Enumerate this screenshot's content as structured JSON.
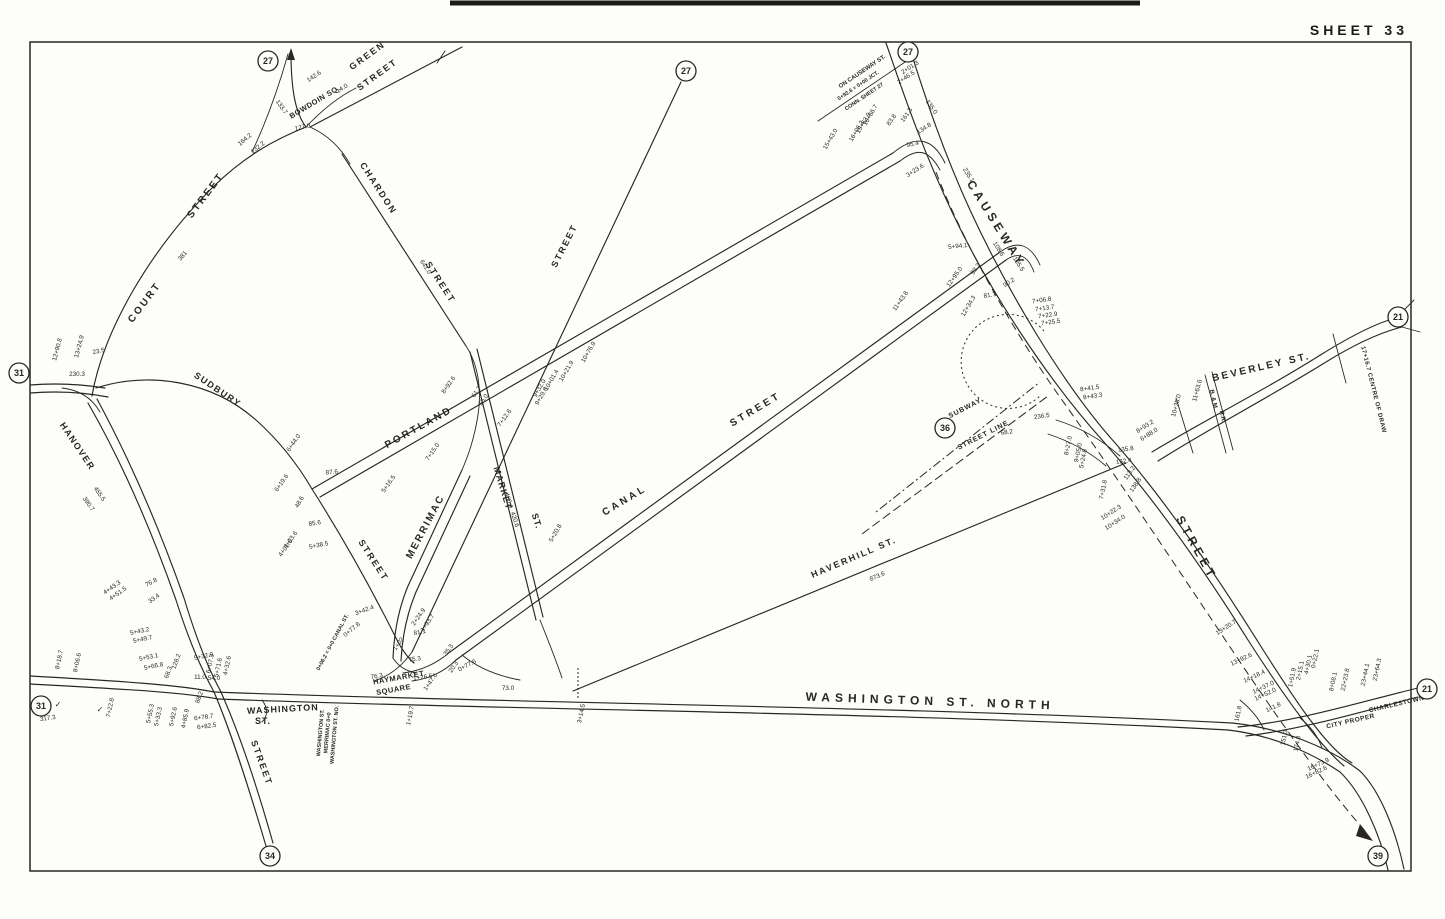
{
  "sheet": {
    "title": "SHEET 33"
  },
  "map": {
    "ink_color": "#2a2722",
    "paper_color": "#fdfdfb",
    "street_labels": [
      {
        "t": "GREEN",
        "x": 369,
        "y": 58,
        "r": -36,
        "s": 9,
        "ls": 2
      },
      {
        "t": "STREET",
        "x": 379,
        "y": 77,
        "r": -36,
        "s": 9,
        "ls": 2
      },
      {
        "t": "BOWDOIN SQ.",
        "x": 316,
        "y": 104,
        "r": -31,
        "s": 7.5,
        "ls": 0.5
      },
      {
        "t": "CHARDON",
        "x": 376,
        "y": 190,
        "r": 57,
        "s": 9,
        "ls": 2
      },
      {
        "t": "STREET",
        "x": 438,
        "y": 284,
        "r": 57,
        "s": 9,
        "ls": 2
      },
      {
        "t": "COURT",
        "x": 147,
        "y": 304,
        "r": -53,
        "s": 10,
        "ls": 2.5
      },
      {
        "t": "STREET",
        "x": 208,
        "y": 197,
        "r": -53,
        "s": 10,
        "ls": 2.5
      },
      {
        "t": "STREET",
        "x": 567,
        "y": 247,
        "r": -63,
        "s": 9,
        "ls": 2
      },
      {
        "t": "SUDBURY",
        "x": 216,
        "y": 392,
        "r": 34,
        "s": 9,
        "ls": 1.5
      },
      {
        "t": "HANOVER",
        "x": 75,
        "y": 448,
        "r": 56,
        "s": 9,
        "ls": 1.5
      },
      {
        "t": "PORTLAND",
        "x": 420,
        "y": 430,
        "r": -29,
        "s": 10,
        "ls": 2.5
      },
      {
        "t": "MERRIMAC",
        "x": 428,
        "y": 528,
        "r": -62,
        "s": 10,
        "ls": 2
      },
      {
        "t": "STREET",
        "x": 371,
        "y": 562,
        "r": 57,
        "s": 9,
        "ls": 2
      },
      {
        "t": "MARKET",
        "x": 500,
        "y": 489,
        "r": 73,
        "s": 9,
        "ls": 1
      },
      {
        "t": "ST.",
        "x": 534,
        "y": 522,
        "r": 73,
        "s": 9,
        "ls": 1
      },
      {
        "t": "CANAL",
        "x": 626,
        "y": 503,
        "r": -31,
        "s": 10,
        "ls": 3
      },
      {
        "t": "STREET",
        "x": 757,
        "y": 412,
        "r": -31,
        "s": 10,
        "ls": 3
      },
      {
        "t": "HAVERHILL ST.",
        "x": 855,
        "y": 560,
        "r": -23,
        "s": 9,
        "ls": 2
      },
      {
        "t": "CAUSEWAY",
        "x": 993,
        "y": 226,
        "r": 58,
        "s": 12,
        "ls": 4
      },
      {
        "t": "STREET",
        "x": 1193,
        "y": 550,
        "r": 61,
        "s": 12,
        "ls": 4
      },
      {
        "t": "BEVERLEY ST.",
        "x": 1262,
        "y": 370,
        "r": -13,
        "s": 10,
        "ls": 2.5
      },
      {
        "t": "WASHINGTON ST. NORTH",
        "x": 930,
        "y": 705,
        "r": 2,
        "s": 12,
        "ls": 5
      },
      {
        "t": "WASHINGTON",
        "x": 283,
        "y": 712,
        "r": -3,
        "s": 9,
        "ls": 1
      },
      {
        "t": "ST.",
        "x": 263,
        "y": 724,
        "r": 0,
        "s": 9,
        "ls": 1
      },
      {
        "t": "HAYMARKET",
        "x": 399,
        "y": 680,
        "r": -10,
        "s": 7.5,
        "ls": 0.5
      },
      {
        "t": "SQUARE",
        "x": 394,
        "y": 692,
        "r": -10,
        "s": 7.5,
        "ls": 0.5
      },
      {
        "t": "STREET",
        "x": 259,
        "y": 764,
        "r": 70,
        "s": 9,
        "ls": 2
      },
      {
        "t": "CITY PROPER",
        "x": 1351,
        "y": 723,
        "r": -13,
        "s": 6.5,
        "ls": 0.5
      },
      {
        "t": "CHARLESTOWN",
        "x": 1397,
        "y": 706,
        "r": -13,
        "s": 6.5,
        "ls": 0.5
      },
      {
        "t": "SUBWAY",
        "x": 966,
        "y": 410,
        "r": -27,
        "s": 7,
        "ls": 1
      },
      {
        "t": "STREET LINE",
        "x": 984,
        "y": 437,
        "r": -27,
        "s": 7,
        "ls": 1
      },
      {
        "t": "ON CAUSEWAY ST.",
        "x": 863,
        "y": 73,
        "r": -34,
        "s": 6,
        "ls": 0
      },
      {
        "t": "0+92.6 = 0+00 JCT.",
        "x": 859,
        "y": 87,
        "r": -34,
        "s": 5.5,
        "ls": 0
      },
      {
        "t": "CONN. SHEET 27",
        "x": 865,
        "y": 98,
        "r": -34,
        "s": 5.5,
        "ls": 0
      },
      {
        "t": "B. & M.",
        "x": 1212,
        "y": 400,
        "r": 78,
        "s": 6,
        "ls": 0
      },
      {
        "t": "R.R.",
        "x": 1221,
        "y": 417,
        "r": 78,
        "s": 6,
        "ls": 0
      },
      {
        "t": "17+16.7  CENTRE OF DRAW",
        "x": 1372,
        "y": 390,
        "r": 76,
        "s": 6,
        "ls": 0.5
      },
      {
        "t": "WASHINGTON ST.",
        "x": 322,
        "y": 733,
        "r": -85,
        "s": 5.5,
        "ls": 0
      },
      {
        "t": "MERRIMAC 0+0",
        "x": 329,
        "y": 733,
        "r": -85,
        "s": 5.5,
        "ls": 0
      },
      {
        "t": "WASHINGTON ST. NO.",
        "x": 336,
        "y": 735,
        "r": -85,
        "s": 5.5,
        "ls": 0
      },
      {
        "t": "0+06.2 = 0+0 CANAL ST.",
        "x": 334,
        "y": 643,
        "r": -62,
        "s": 5.5,
        "ls": 0
      }
    ],
    "annotations": [
      {
        "t": "142.6",
        "x": 315,
        "y": 78,
        "r": -33
      },
      {
        "t": "14.0",
        "x": 343,
        "y": 90,
        "r": -33
      },
      {
        "t": "133.7",
        "x": 280,
        "y": 108,
        "r": 55
      },
      {
        "t": "127.0",
        "x": 303,
        "y": 129,
        "r": -12
      },
      {
        "t": "164.2",
        "x": 246,
        "y": 141,
        "r": -40
      },
      {
        "t": "232.2",
        "x": 259,
        "y": 149,
        "r": -40
      },
      {
        "t": "381",
        "x": 184,
        "y": 257,
        "r": -50
      },
      {
        "t": "641.0",
        "x": 424,
        "y": 268,
        "r": 57
      },
      {
        "t": "12+90.8",
        "x": 59,
        "y": 350,
        "r": -75
      },
      {
        "t": "13+24.9",
        "x": 81,
        "y": 347,
        "r": -75
      },
      {
        "t": "23.5",
        "x": 99,
        "y": 353,
        "r": -12
      },
      {
        "t": "230.3",
        "x": 77,
        "y": 376,
        "r": 0
      },
      {
        "t": "455.5",
        "x": 98,
        "y": 495,
        "r": 55
      },
      {
        "t": "390.7",
        "x": 87,
        "y": 505,
        "r": 55
      },
      {
        "t": "8+18.7",
        "x": 61,
        "y": 660,
        "r": -78
      },
      {
        "t": "8+06.6",
        "x": 79,
        "y": 663,
        "r": -78
      },
      {
        "t": "317.3",
        "x": 48,
        "y": 720,
        "r": -8
      },
      {
        "t": "7+22.8",
        "x": 112,
        "y": 708,
        "r": -78
      },
      {
        "t": "✓",
        "x": 58,
        "y": 707,
        "r": 0,
        "s": 8
      },
      {
        "t": "✓",
        "x": 100,
        "y": 712,
        "r": 0,
        "s": 8
      },
      {
        "t": "4+43.3",
        "x": 113,
        "y": 589,
        "r": -35
      },
      {
        "t": "4+51.5",
        "x": 119,
        "y": 595,
        "r": -35
      },
      {
        "t": "76.8",
        "x": 152,
        "y": 584,
        "r": -28
      },
      {
        "t": "33.4",
        "x": 155,
        "y": 600,
        "r": -35
      },
      {
        "t": "5+43.2",
        "x": 140,
        "y": 633,
        "r": -12
      },
      {
        "t": "5+49.7",
        "x": 143,
        "y": 641,
        "r": -12
      },
      {
        "t": "5+53.1",
        "x": 149,
        "y": 659,
        "r": -12
      },
      {
        "t": "5+66.8",
        "x": 154,
        "y": 668,
        "r": -12
      },
      {
        "t": "128.2",
        "x": 178,
        "y": 662,
        "r": -70
      },
      {
        "t": "68.3",
        "x": 170,
        "y": 673,
        "r": -70
      },
      {
        "t": "5+32.9",
        "x": 204,
        "y": 658,
        "r": -12
      },
      {
        "t": "6+07.3",
        "x": 212,
        "y": 664,
        "r": -78
      },
      {
        "t": "5+71.6",
        "x": 220,
        "y": 668,
        "r": -78
      },
      {
        "t": "4+32.6",
        "x": 229,
        "y": 666,
        "r": -78
      },
      {
        "t": "11.0",
        "x": 200,
        "y": 679,
        "r": 0
      },
      {
        "t": "54.0",
        "x": 214,
        "y": 680,
        "r": 0
      },
      {
        "t": "88.2",
        "x": 201,
        "y": 698,
        "r": -70
      },
      {
        "t": "5+55.3",
        "x": 152,
        "y": 714,
        "r": -78
      },
      {
        "t": "5+33.3",
        "x": 160,
        "y": 717,
        "r": -78
      },
      {
        "t": "5+92.6",
        "x": 175,
        "y": 717,
        "r": -78
      },
      {
        "t": "4+85.9",
        "x": 187,
        "y": 719,
        "r": -78
      },
      {
        "t": "6+78.7",
        "x": 204,
        "y": 719,
        "r": -8
      },
      {
        "t": "6+82.5",
        "x": 207,
        "y": 728,
        "r": -8
      },
      {
        "t": "76.3",
        "x": 377,
        "y": 678,
        "r": -10
      },
      {
        "t": "3+42.4",
        "x": 365,
        "y": 612,
        "r": -20
      },
      {
        "t": "0+77.8",
        "x": 353,
        "y": 631,
        "r": -40
      },
      {
        "t": "2+24.9",
        "x": 420,
        "y": 618,
        "r": -55
      },
      {
        "t": "1+93.7",
        "x": 429,
        "y": 624,
        "r": -55
      },
      {
        "t": "81.1",
        "x": 420,
        "y": 634,
        "r": -10
      },
      {
        "t": "1+02",
        "x": 400,
        "y": 645,
        "r": -55
      },
      {
        "t": "75.3",
        "x": 415,
        "y": 661,
        "r": -8
      },
      {
        "t": "1+26.5",
        "x": 423,
        "y": 679,
        "r": -8
      },
      {
        "t": "1+47.6",
        "x": 432,
        "y": 683,
        "r": -55
      },
      {
        "t": "35.3",
        "x": 450,
        "y": 651,
        "r": -55
      },
      {
        "t": "20.3",
        "x": 455,
        "y": 668,
        "r": -55
      },
      {
        "t": "0+77.6",
        "x": 468,
        "y": 667,
        "r": -28
      },
      {
        "t": "73.0",
        "x": 508,
        "y": 690,
        "r": 0
      },
      {
        "t": "1+19.7",
        "x": 412,
        "y": 716,
        "r": -78
      },
      {
        "t": "3+14.5",
        "x": 583,
        "y": 714,
        "r": -78
      },
      {
        "t": "6+44.0",
        "x": 295,
        "y": 444,
        "r": -55
      },
      {
        "t": "6+19.6",
        "x": 283,
        "y": 484,
        "r": -55
      },
      {
        "t": "48.6",
        "x": 301,
        "y": 503,
        "r": -60
      },
      {
        "t": "87.6",
        "x": 332,
        "y": 474,
        "r": -6
      },
      {
        "t": "5+16.5",
        "x": 390,
        "y": 485,
        "r": -55
      },
      {
        "t": "7+15.0",
        "x": 434,
        "y": 453,
        "r": -55
      },
      {
        "t": "8+92.6",
        "x": 450,
        "y": 386,
        "r": -55
      },
      {
        "t": "85.6",
        "x": 315,
        "y": 525,
        "r": -8
      },
      {
        "t": "4+03.6",
        "x": 292,
        "y": 541,
        "r": -55
      },
      {
        "t": "4+01.6",
        "x": 287,
        "y": 549,
        "r": -55
      },
      {
        "t": "5+38.5",
        "x": 319,
        "y": 547,
        "r": -12
      },
      {
        "t": "61.7",
        "x": 478,
        "y": 393,
        "r": -55
      },
      {
        "t": "55.0",
        "x": 485,
        "y": 401,
        "r": -55
      },
      {
        "t": "7+12.8",
        "x": 506,
        "y": 419,
        "r": -55
      },
      {
        "t": "460.4",
        "x": 507,
        "y": 501,
        "r": 72
      },
      {
        "t": "420.6",
        "x": 513,
        "y": 520,
        "r": 72
      },
      {
        "t": "5+20.8",
        "x": 557,
        "y": 534,
        "r": -60
      },
      {
        "t": "10+76.9",
        "x": 590,
        "y": 353,
        "r": -60
      },
      {
        "t": "10+21.9",
        "x": 568,
        "y": 372,
        "r": -60
      },
      {
        "t": "10+01.4",
        "x": 553,
        "y": 381,
        "r": -60
      },
      {
        "t": "9+32.0",
        "x": 541,
        "y": 389,
        "r": -60
      },
      {
        "t": "9+29.6",
        "x": 543,
        "y": 397,
        "r": -60
      },
      {
        "t": "2+01.3",
        "x": 911,
        "y": 69,
        "r": -33
      },
      {
        "t": "2+46.5",
        "x": 907,
        "y": 79,
        "r": -33
      },
      {
        "t": "135.0",
        "x": 930,
        "y": 108,
        "r": 55
      },
      {
        "t": "134.8",
        "x": 925,
        "y": 130,
        "r": -33
      },
      {
        "t": "16+66.7",
        "x": 872,
        "y": 116,
        "r": -60
      },
      {
        "t": "15+63.9",
        "x": 865,
        "y": 124,
        "r": -60
      },
      {
        "t": "16+06.2",
        "x": 858,
        "y": 132,
        "r": -60
      },
      {
        "t": "15+43.0",
        "x": 832,
        "y": 140,
        "r": -60
      },
      {
        "t": "83.8",
        "x": 893,
        "y": 121,
        "r": -55
      },
      {
        "t": "161.3",
        "x": 908,
        "y": 116,
        "r": -55
      },
      {
        "t": "95.4",
        "x": 913,
        "y": 146,
        "r": -12
      },
      {
        "t": "3+23.6",
        "x": 916,
        "y": 172,
        "r": -33
      },
      {
        "t": "235.1",
        "x": 967,
        "y": 176,
        "r": 57
      },
      {
        "t": "5+94.1",
        "x": 958,
        "y": 248,
        "r": -6
      },
      {
        "t": "108.6",
        "x": 997,
        "y": 250,
        "r": 57
      },
      {
        "t": "105.5",
        "x": 1017,
        "y": 265,
        "r": 57
      },
      {
        "t": "92.2",
        "x": 977,
        "y": 270,
        "r": -55
      },
      {
        "t": "12+95.0",
        "x": 956,
        "y": 278,
        "r": -55
      },
      {
        "t": "90.2",
        "x": 1010,
        "y": 284,
        "r": -33
      },
      {
        "t": "81.7",
        "x": 990,
        "y": 297,
        "r": -8
      },
      {
        "t": "12+34.3",
        "x": 970,
        "y": 307,
        "r": -60
      },
      {
        "t": "11+43.8",
        "x": 902,
        "y": 302,
        "r": -55
      },
      {
        "t": "7+06.8",
        "x": 1042,
        "y": 302,
        "r": -8
      },
      {
        "t": "7+13.7",
        "x": 1045,
        "y": 310,
        "r": -8
      },
      {
        "t": "7+22.9",
        "x": 1048,
        "y": 317,
        "r": -8
      },
      {
        "t": "7+25.5",
        "x": 1051,
        "y": 324,
        "r": -8
      },
      {
        "t": "8+41.5",
        "x": 1090,
        "y": 390,
        "r": -8
      },
      {
        "t": "8+43.3",
        "x": 1093,
        "y": 398,
        "r": -8
      },
      {
        "t": "236.5",
        "x": 1042,
        "y": 418,
        "r": -8
      },
      {
        "t": "68.2",
        "x": 1007,
        "y": 434,
        "r": -8
      },
      {
        "t": "8+93.2",
        "x": 1146,
        "y": 428,
        "r": -33
      },
      {
        "t": "6+88.0",
        "x": 1150,
        "y": 436,
        "r": -33
      },
      {
        "t": "135.8",
        "x": 1126,
        "y": 451,
        "r": -8
      },
      {
        "t": "132.4",
        "x": 1124,
        "y": 463,
        "r": -8
      },
      {
        "t": "113.2",
        "x": 1131,
        "y": 474,
        "r": -55
      },
      {
        "t": "138.8",
        "x": 1137,
        "y": 486,
        "r": -55
      },
      {
        "t": "8+27.0",
        "x": 1070,
        "y": 446,
        "r": -78
      },
      {
        "t": "9+05.0",
        "x": 1080,
        "y": 453,
        "r": -78
      },
      {
        "t": "5+24.8",
        "x": 1085,
        "y": 459,
        "r": -78
      },
      {
        "t": "7+31.8",
        "x": 1105,
        "y": 490,
        "r": -78
      },
      {
        "t": "10+22.3",
        "x": 1112,
        "y": 514,
        "r": -33
      },
      {
        "t": "10+34.0",
        "x": 1116,
        "y": 524,
        "r": -33
      },
      {
        "t": "10+35.0",
        "x": 1178,
        "y": 406,
        "r": -75
      },
      {
        "t": "11+63.6",
        "x": 1199,
        "y": 391,
        "r": -75
      },
      {
        "t": "873.6",
        "x": 878,
        "y": 578,
        "r": -23
      },
      {
        "t": "13+20.7",
        "x": 1227,
        "y": 629,
        "r": -33
      },
      {
        "t": "13+92.6",
        "x": 1242,
        "y": 661,
        "r": -25
      },
      {
        "t": "14+18.4",
        "x": 1255,
        "y": 678,
        "r": -25
      },
      {
        "t": "14+37.0",
        "x": 1264,
        "y": 689,
        "r": -25
      },
      {
        "t": "14+52.0",
        "x": 1266,
        "y": 696,
        "r": -25
      },
      {
        "t": "141.8",
        "x": 1274,
        "y": 709,
        "r": -25
      },
      {
        "t": "161.8",
        "x": 1240,
        "y": 714,
        "r": -78
      },
      {
        "t": "151.3",
        "x": 1286,
        "y": 738,
        "r": -78
      },
      {
        "t": "174.8",
        "x": 1299,
        "y": 744,
        "r": -78
      },
      {
        "t": "16+73.9",
        "x": 1319,
        "y": 766,
        "r": -25
      },
      {
        "t": "16+82.6",
        "x": 1317,
        "y": 774,
        "r": -25
      },
      {
        "t": "1+51.9",
        "x": 1294,
        "y": 678,
        "r": -78
      },
      {
        "t": "2+15.1",
        "x": 1302,
        "y": 671,
        "r": -78
      },
      {
        "t": "4+30.1",
        "x": 1310,
        "y": 665,
        "r": -78
      },
      {
        "t": "0+22.1",
        "x": 1317,
        "y": 659,
        "r": -78
      },
      {
        "t": "8+08.1",
        "x": 1335,
        "y": 682,
        "r": -78
      },
      {
        "t": "22+23.8",
        "x": 1347,
        "y": 680,
        "r": -78
      },
      {
        "t": "23+44.1",
        "x": 1367,
        "y": 675,
        "r": -78
      },
      {
        "t": "23+64.3",
        "x": 1379,
        "y": 670,
        "r": -78
      }
    ],
    "reference_circles": [
      {
        "n": "27",
        "x": 268,
        "y": 61
      },
      {
        "n": "27",
        "x": 686,
        "y": 71
      },
      {
        "n": "27",
        "x": 908,
        "y": 52
      },
      {
        "n": "31",
        "x": 19,
        "y": 373
      },
      {
        "n": "31",
        "x": 41,
        "y": 706
      },
      {
        "n": "21",
        "x": 1398,
        "y": 317
      },
      {
        "n": "36",
        "x": 945,
        "y": 428
      },
      {
        "n": "34",
        "x": 270,
        "y": 856
      },
      {
        "n": "21",
        "x": 1427,
        "y": 689
      },
      {
        "n": "39",
        "x": 1378,
        "y": 856
      }
    ]
  }
}
